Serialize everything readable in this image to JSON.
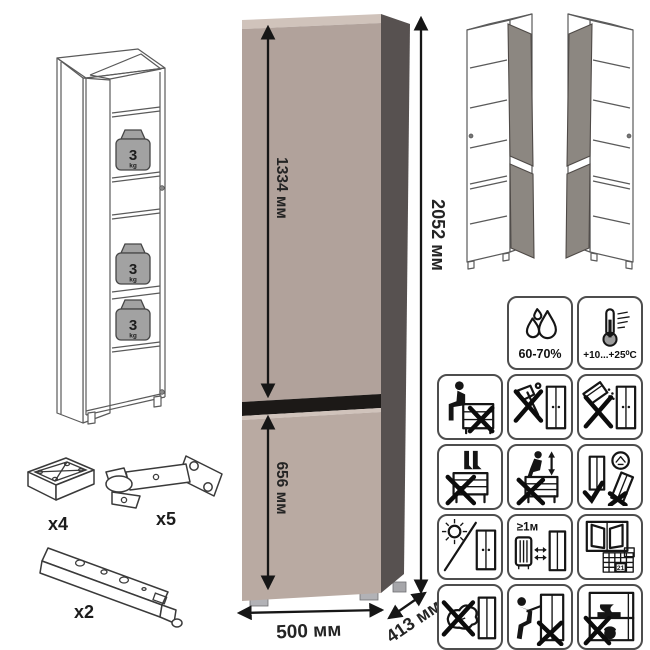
{
  "product": {
    "dimensions": {
      "total_height": "2052 мм",
      "upper_door_height": "1334 мм",
      "lower_door_height": "656 мм",
      "width": "500 мм",
      "depth": "413 мм"
    },
    "shelf_load": {
      "value": "3",
      "unit": "kg"
    },
    "colors": {
      "front_upper": "#b1a29b",
      "front_lower": "#b9aaa2",
      "side_panel": "#575150",
      "top_edge": "#d0c3bb",
      "door_gap": "#1c1917",
      "wireframe_door": "#8c8781"
    }
  },
  "hardware": {
    "foot_qty": "x4",
    "hinge_qty": "x5",
    "rail_qty": "x2"
  },
  "conditions": {
    "humidity_range": "60-70%",
    "temperature_range": "+10...+25⁰C"
  },
  "warnings": {
    "heater_distance": "≥1м",
    "acclimatization_day": "21"
  }
}
